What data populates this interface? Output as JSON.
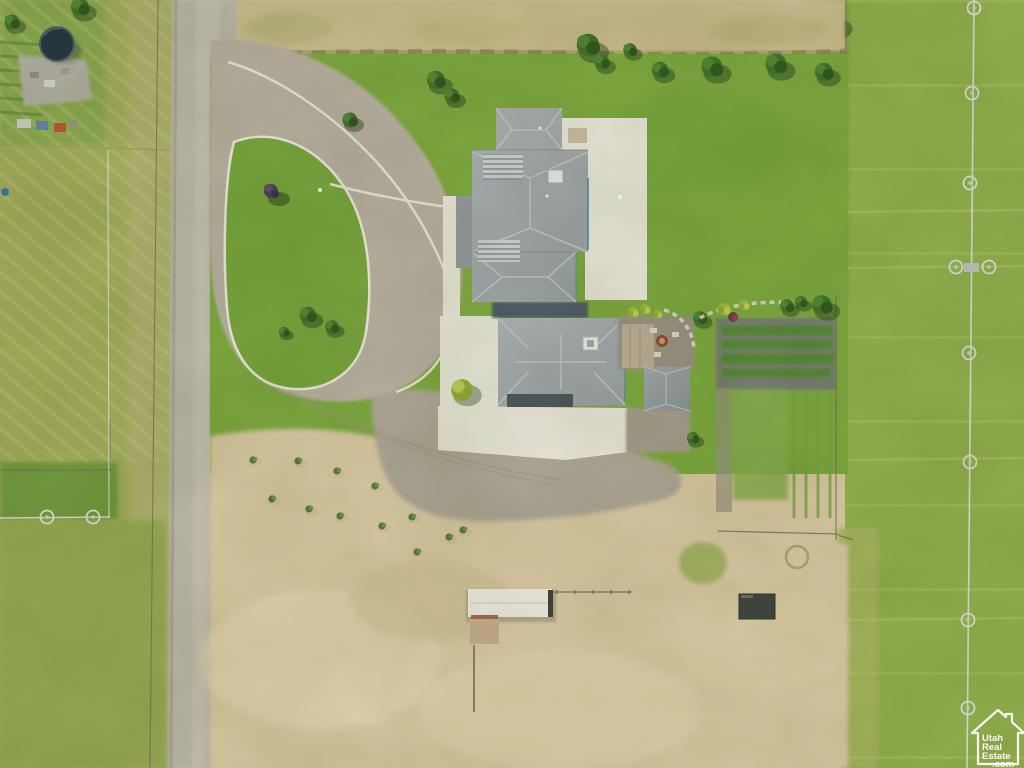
{
  "watermark": {
    "brand_lines": [
      "Utah",
      "Real",
      "Estate",
      ".com"
    ],
    "icon": "house-outline-icon",
    "color": "#ffffff"
  },
  "palette": {
    "lawn": "#74a03c",
    "pasture_left": "#9aa455",
    "pasture_right": "#87a94a",
    "dry_field": "#c7b689",
    "dirt": "#d6c49c",
    "road_gravel": "#b6b0a4",
    "loop_gravel": "#b2a89b",
    "courtyard_gravel": "#a69d8f",
    "concrete": "#e9e6dc",
    "roof": "#9aa0a7",
    "roof_dark": "#6e757e",
    "island_grass": "#6f9c3a",
    "garden_barrier": "#70746a",
    "garden_row": "#4f8030",
    "tarp": "#3c423c",
    "shed_roof": "#eceae2",
    "trampoline": "#26343f",
    "fence": "#5f604c",
    "irrigation_pipe": "#d9ded9",
    "watermark": "#ffffff"
  },
  "scene": {
    "type": "aerial-drone-photo",
    "features": [
      "farm-house",
      "detached-garage",
      "gravel-driveway-loop",
      "grass-island",
      "concrete-walkway",
      "back-patio-fire-pit",
      "vegetable-garden-rows",
      "lawn",
      "dry-hay-field",
      "pasture-left",
      "pasture-right",
      "dirt-lot",
      "orchard-shrub-rows",
      "white-shed",
      "dark-tarp",
      "trampoline",
      "wheel-line-irrigation",
      "dirt-road",
      "fence-lines"
    ]
  }
}
